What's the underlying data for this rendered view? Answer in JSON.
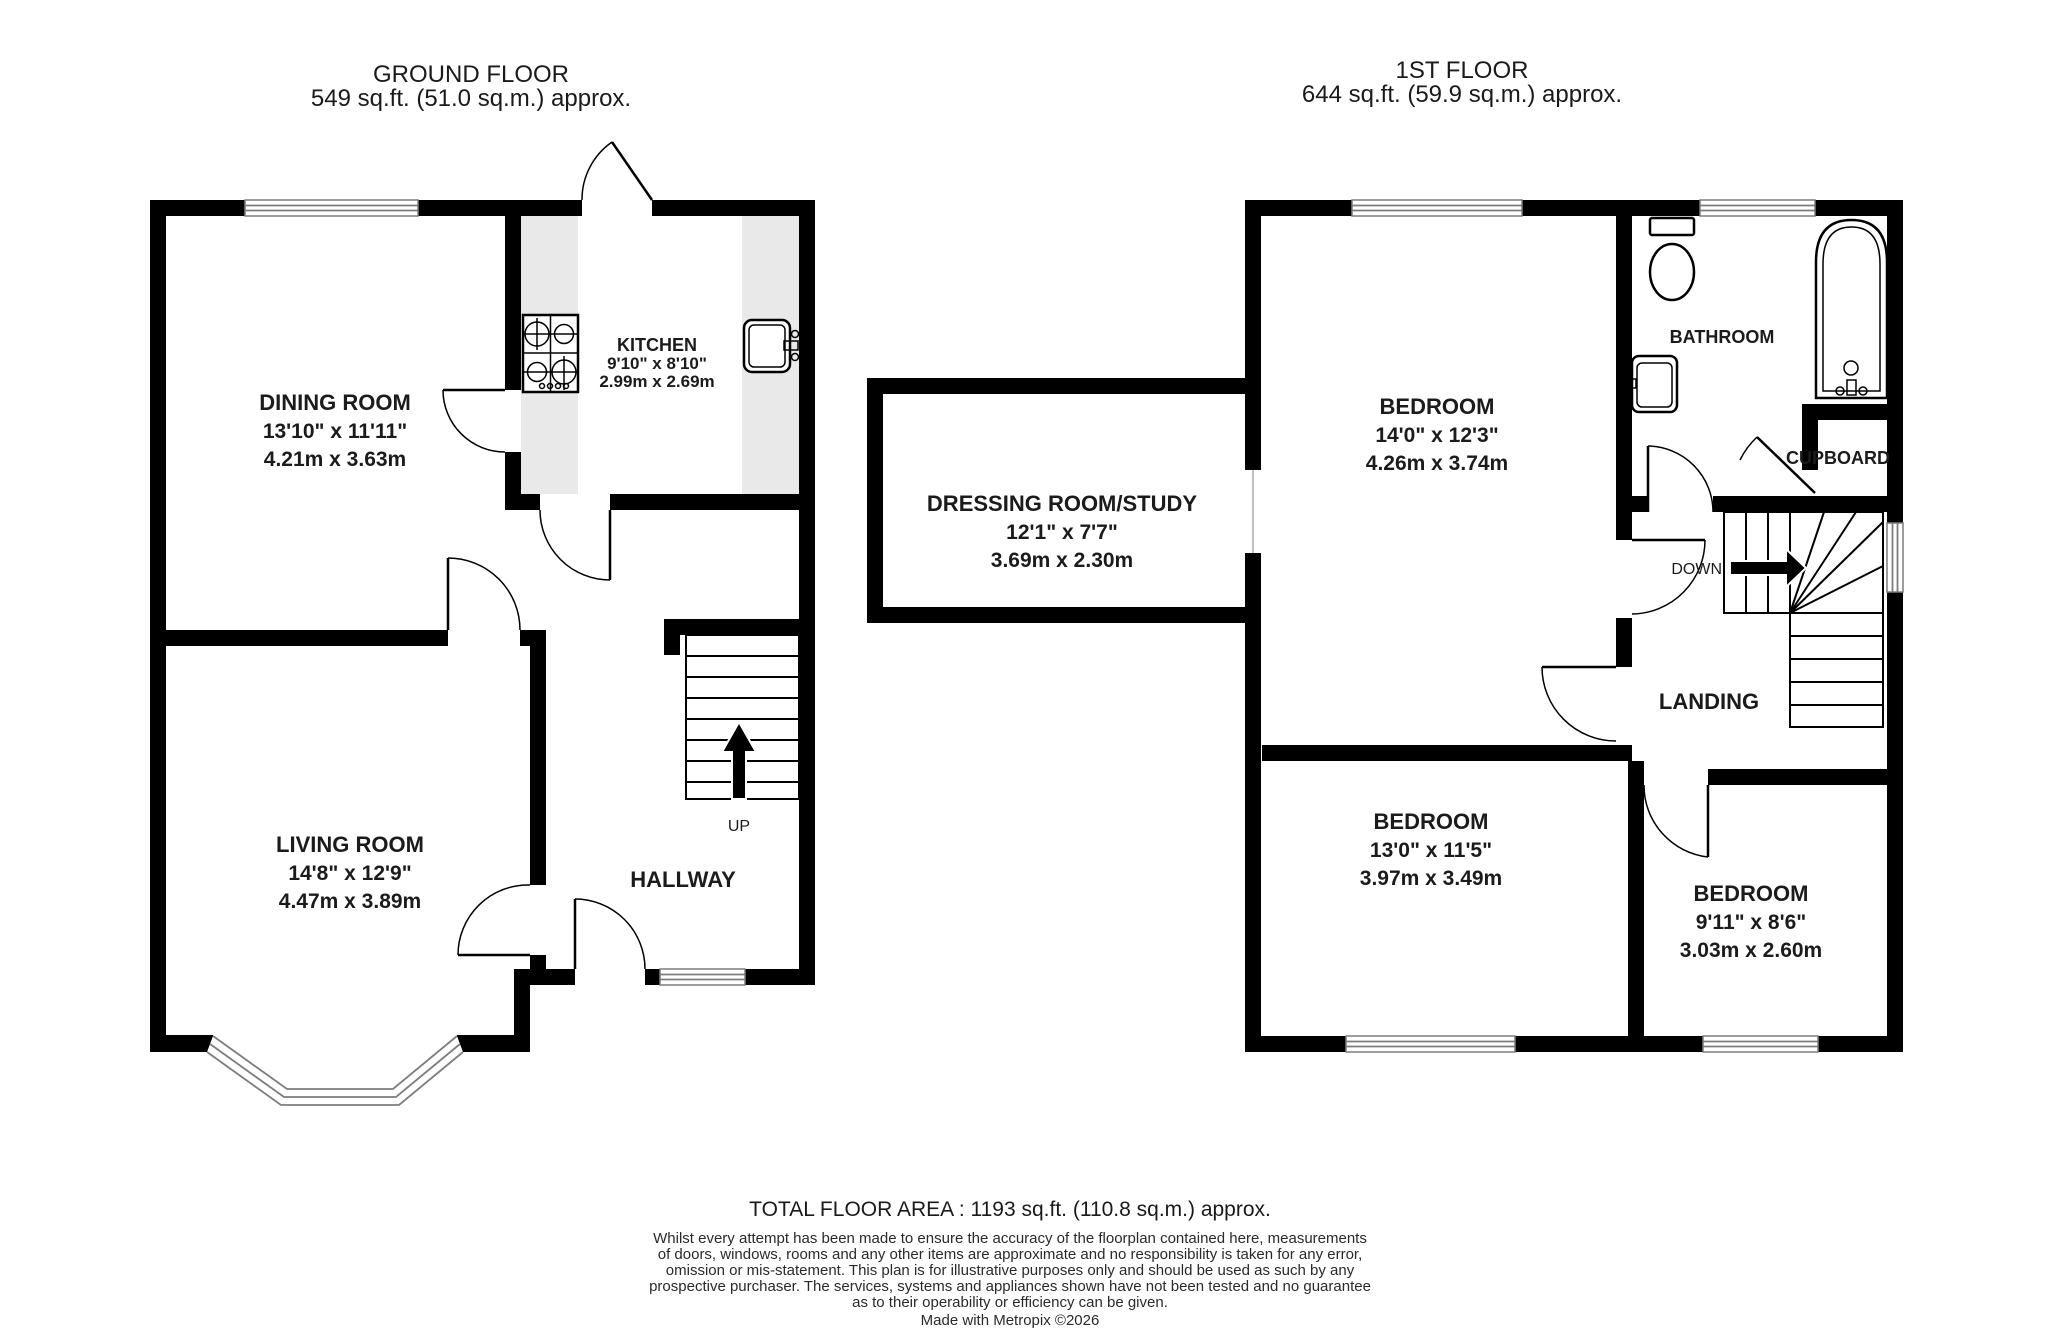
{
  "ground_floor": {
    "title": "GROUND FLOOR",
    "area": "549 sq.ft. (51.0 sq.m.) approx.",
    "dining": {
      "name": "DINING ROOM",
      "imperial": "13'10\" x 11'11\"",
      "metric": "4.21m x 3.63m"
    },
    "kitchen": {
      "name": "KITCHEN",
      "imperial": "9'10\" x 8'10\"",
      "metric": "2.99m x 2.69m"
    },
    "living": {
      "name": "LIVING ROOM",
      "imperial": "14'8\" x 12'9\"",
      "metric": "4.47m x 3.89m"
    },
    "hallway": {
      "name": "HALLWAY"
    },
    "stairs_up_label": "UP"
  },
  "first_floor": {
    "title": "1ST FLOOR",
    "area": "644 sq.ft. (59.9 sq.m.) approx.",
    "bedroom1": {
      "name": "BEDROOM",
      "imperial": "14'0\" x 12'3\"",
      "metric": "4.26m x 3.74m"
    },
    "bathroom": {
      "name": "BATHROOM"
    },
    "cupboard": {
      "name": "CUPBOARD"
    },
    "dressing_room": {
      "name": "DRESSING ROOM/STUDY",
      "imperial": "12'1\" x 7'7\"",
      "metric": "3.69m x 2.30m"
    },
    "landing": {
      "name": "LANDING"
    },
    "stairs_down_label": "DOWN",
    "bedroom2": {
      "name": "BEDROOM",
      "imperial": "13'0\" x 11'5\"",
      "metric": "3.97m x 3.49m"
    },
    "bedroom3": {
      "name": "BEDROOM",
      "imperial": "9'11\" x 8'6\"",
      "metric": "3.03m x 2.60m"
    }
  },
  "footer": {
    "total_area": "TOTAL FLOOR AREA : 1193 sq.ft. (110.8 sq.m.) approx.",
    "disclaimer_lines": [
      "Whilst every attempt has been made to ensure the accuracy of the floorplan contained here, measurements",
      "of doors, windows, rooms and any other items are approximate and no responsibility is taken for any error,",
      "omission or mis-statement. This plan is for illustrative purposes only and should be used as such by any",
      "prospective purchaser. The services, systems and appliances shown have not been tested and no guarantee",
      "as to their operability or efficiency can be given."
    ],
    "credit": "Made with Metropix ©2026"
  }
}
